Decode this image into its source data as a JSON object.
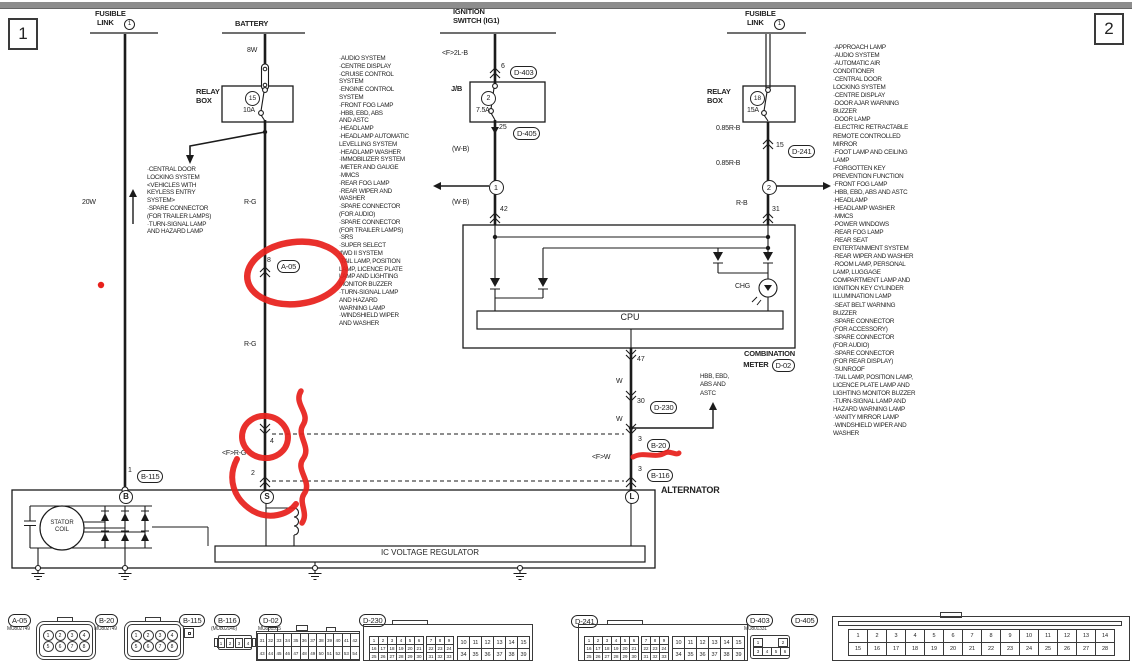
{
  "colors": {
    "line": "#1b1b1b",
    "annotation_red": "#e8211c"
  },
  "page": {
    "num_left": "1",
    "num_right": "2"
  },
  "headers": {
    "fusible_left_1": "FUSIBLE",
    "fusible_left_2": "LINK",
    "fusible_left_no": "1",
    "battery": "BATTERY",
    "ignition_1": "IGNITION",
    "ignition_2": "SWITCH (IG1)",
    "fusible_right_1": "FUSIBLE",
    "fusible_right_2": "LINK",
    "fusible_right_no": "1"
  },
  "left_col": {
    "wire_20w": "20W",
    "branch_systems": [
      "·CENTRAL DOOR",
      "LOCKING SYSTEM",
      "<VEHICLES WITH",
      "KEYLESS ENTRY",
      "SYSTEM>",
      "·SPARE CONNECTOR",
      "(FOR TRAILER LAMPS)",
      "·TURN-SIGNAL LAMP",
      "AND HAZARD LAMP"
    ],
    "pin1": "1",
    "conn_b115": "B-115"
  },
  "battery_col": {
    "wire_8w": "8W",
    "relay_box_1": "RELAY",
    "relay_box_2": "BOX",
    "fuse_no": "15",
    "fuse_rating": "10A",
    "wire_rg_1": "R-G",
    "pin8": "8",
    "conn_a05": "A-05",
    "wire_rg_2": "R-G",
    "pin4": "4",
    "wire_frg": "<F>R-G",
    "pin2": "2"
  },
  "ignition_col": {
    "wire_2lb": "<F>2L-B",
    "pin6": "6",
    "conn_d403": "D-403",
    "jb": "J/B",
    "fuse_no": "2",
    "fuse_rating": "7.5A",
    "pin25": "25",
    "conn_d405": "D-405",
    "wire_wb_1": "(W-B)",
    "junction_no": "1",
    "wire_wb_2": "(W-B)",
    "pin42": "42"
  },
  "right_col": {
    "relay_box_1": "RELAY",
    "relay_box_2": "BOX",
    "fuse_no": "18",
    "fuse_rating": "15A",
    "wire_085rb_1": "0.85R-B",
    "pin15": "15",
    "conn_d241": "D-241",
    "wire_085rb_2": "0.85R-B",
    "junction_no": "2",
    "wire_rb": "R-B",
    "pin31": "31"
  },
  "mid_systems": [
    "·AUDIO SYSTEM",
    "·CENTRE DISPLAY",
    "·CRUISE CONTROL",
    "SYSTEM",
    "·ENGINE CONTROL",
    "SYSTEM",
    "·FRONT FOG LAMP",
    "·HBB, EBD, ABS",
    "AND ASTC",
    "·HEADLAMP",
    "·HEADLAMP AUTOMATIC",
    "LEVELLING SYSTEM",
    "·HEADLAMP WASHER",
    "·IMMOBILIZER SYSTEM",
    "·METER AND GAUGE",
    "·MMCS",
    "·REAR FOG LAMP",
    "·REAR WIPER AND",
    "WASHER",
    "·SPARE CONNECTOR",
    "(FOR AUDIO)",
    "·SPARE CONNECTOR",
    "(FOR TRAILER LAMPS)",
    "·SRS",
    "·SUPER SELECT",
    "4WD II SYSTEM",
    "·TAIL LAMP, POSITION",
    "LAMP, LICENCE PLATE",
    "LAMP AND LIGHTING",
    "MONITOR BUZZER",
    "·TURN-SIGNAL LAMP",
    "AND HAZARD",
    "WARNING LAMP",
    "·WINDSHIELD WIPER",
    "AND WASHER"
  ],
  "right_systems": [
    "·APPROACH LAMP",
    "·AUDIO SYSTEM",
    "·AUTOMATIC AIR",
    "CONDITIONER",
    "·CENTRAL DOOR",
    "LOCKING SYSTEM",
    "·CENTRE DISPLAY",
    "·DOOR AJAR WARNING",
    "BUZZER",
    "·DOOR LAMP",
    "·ELECTRIC RETRACTABLE",
    "REMOTE CONTROLLED",
    "MIRROR",
    "·FOOT LAMP AND CEILING",
    "LAMP",
    "·FORGOTTEN KEY",
    "PREVENTION FUNCTION",
    "·FRONT FOG LAMP",
    "·HBB, EBD, ABS AND ASTC",
    "·HEADLAMP",
    "·HEADLAMP WASHER",
    "·MMCS",
    "·POWER WINDOWS",
    "·REAR FOG LAMP",
    "·REAR SEAT",
    "ENTERTAINMENT SYSTEM",
    "·REAR WIPER AND WASHER",
    "·ROOM LAMP, PERSONAL",
    "LAMP, LUGGAGE",
    "COMPARTMENT LAMP AND",
    "IGNITION KEY CYLINDER",
    "ILLUMINATION LAMP",
    "·SEAT BELT WARNING",
    "BUZZER",
    "·SPARE CONNECTOR",
    "(FOR ACCESSORY)",
    "·SPARE CONNECTOR",
    "(FOR AUDIO)",
    "·SPARE CONNECTOR",
    "(FOR REAR DISPLAY)",
    "·SUNROOF",
    "·TAIL LAMP, POSITION LAMP,",
    "LICENCE PLATE LAMP AND",
    "LIGHTING MONITOR BUZZER",
    "·TURN-SIGNAL LAMP AND",
    "HAZARD WARNING LAMP",
    "·VANITY MIRROR LAMP",
    "·WINDSHIELD WIPER AND",
    "WASHER"
  ],
  "meter": {
    "cpu": "CPU",
    "chg": "CHG",
    "label_1": "COMBINATION",
    "label_2": "METER",
    "conn_d02": "D-02",
    "pin47": "47",
    "wire_w1": "W",
    "pin30": "30",
    "conn_d230": "D-230",
    "wire_w2": "W",
    "pin3a": "3",
    "conn_b20": "B-20",
    "wire_fw": "<F>W",
    "pin3b": "3",
    "conn_b116": "B-116",
    "hbb": [
      "HBB, EBD,",
      "ABS AND",
      "ASTC"
    ]
  },
  "alternator": {
    "label": "ALTERNATOR",
    "term_b": "B",
    "term_s": "S",
    "term_l": "L",
    "stator_1": "STATOR",
    "stator_2": "COIL",
    "regulator": "IC VOLTAGE REGULATOR"
  },
  "connectors": {
    "a05": {
      "id": "A-05",
      "part": "MU802749",
      "top": [
        "1",
        "2",
        "3",
        "4"
      ],
      "bot": [
        "5",
        "6",
        "7",
        "8"
      ]
    },
    "b20": {
      "id": "B-20",
      "part": "MU802749",
      "top": [
        "1",
        "2",
        "3",
        "4"
      ],
      "bot": [
        "5",
        "6",
        "7",
        "8"
      ]
    },
    "b115": {
      "id": "B-115"
    },
    "b116": {
      "id": "B-116",
      "part": "(MU802046)",
      "pins": [
        "1",
        "2",
        "3",
        "4"
      ]
    },
    "d02": {
      "id": "D-02",
      "part": "MU801515",
      "row1": [
        "31",
        "32",
        "33",
        "34",
        "35",
        "36",
        "37",
        "38",
        "39",
        "40",
        "41",
        "42"
      ],
      "row2": [
        "43",
        "44",
        "45",
        "46",
        "47",
        "48",
        "49",
        "50",
        "51",
        "52",
        "53",
        "54"
      ]
    },
    "d230": {
      "id": "D-230",
      "s1": [
        "1",
        "2",
        "3",
        "4",
        "5",
        "6"
      ],
      "m1": [
        "7",
        "8",
        "9"
      ],
      "s2": [
        "16",
        "17",
        "18",
        "19",
        "20",
        "21"
      ],
      "m2": [
        "22",
        "23",
        "24"
      ],
      "s3": [
        "25",
        "26",
        "27",
        "28",
        "29",
        "30"
      ],
      "m3": [
        "31",
        "32",
        "33"
      ],
      "b1": [
        "10",
        "11",
        "12",
        "13",
        "14",
        "15"
      ],
      "b2": [
        "34",
        "35",
        "36",
        "37",
        "38",
        "39"
      ]
    },
    "d241": {
      "id": "D-241",
      "s1": [
        "1",
        "2",
        "3",
        "4",
        "5",
        "6"
      ],
      "m1": [
        "7",
        "8",
        "9"
      ],
      "s2": [
        "16",
        "17",
        "18",
        "19",
        "20",
        "21"
      ],
      "m2": [
        "22",
        "23",
        "24"
      ],
      "s3": [
        "25",
        "26",
        "27",
        "28",
        "29",
        "30"
      ],
      "m3": [
        "31",
        "32",
        "33"
      ],
      "b1": [
        "10",
        "11",
        "12",
        "13",
        "14",
        "15"
      ],
      "b2": [
        "34",
        "35",
        "36",
        "37",
        "38",
        "39"
      ]
    },
    "d403": {
      "id": "D-403",
      "part": "MU801331",
      "p1": "1",
      "p2": "2",
      "row2": [
        "3",
        "4",
        "5",
        "6"
      ]
    },
    "d405": {
      "id": "D-405",
      "row1": [
        "1",
        "2",
        "3",
        "4",
        "5",
        "6",
        "7",
        "8",
        "9",
        "10",
        "11",
        "12",
        "13",
        "14"
      ],
      "row2": [
        "15",
        "16",
        "17",
        "18",
        "19",
        "20",
        "21",
        "22",
        "23",
        "24",
        "25",
        "26",
        "27",
        "28"
      ]
    }
  }
}
